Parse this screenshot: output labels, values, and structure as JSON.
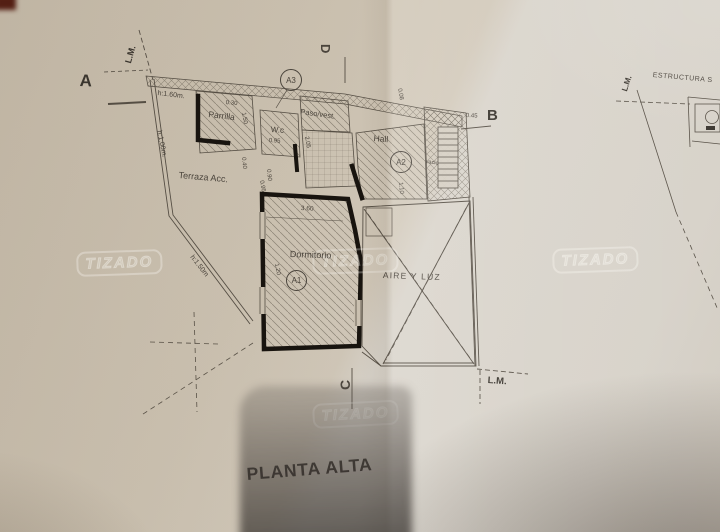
{
  "title": "PLANTA ALTA",
  "watermark_text": "TIZADO",
  "plan": {
    "rooms": {
      "parrilla": "Parrilla",
      "wc": "W.c",
      "paso_vest": "Paso/vest.",
      "hall": "Hall",
      "terraza": "Terraza Acc.",
      "dormitorio": "Dormitorio",
      "aire_y_luz": "AIRE Y LUZ",
      "vacio": "vacio"
    },
    "tags": {
      "a1": "A1",
      "a2": "A2",
      "a3": "A3"
    },
    "section_marks": {
      "a": "A",
      "b": "B",
      "c": "C",
      "d": "D"
    },
    "boundary": {
      "lm_top_left": "L.M.",
      "lm_bottom_right": "L.M.",
      "lm_top_right": "L.M."
    },
    "heights": {
      "parapet_160": "h:1.60m.",
      "parapet_100": "h:1.00m.",
      "parapet_150": "h:1.50m"
    },
    "dimensions": {
      "parrilla_width": "0.30",
      "parrilla_side": "1.50",
      "wc_width": "0.95",
      "paso_depth": "2.05",
      "wall_040": "0.40",
      "wall_090": "0.90",
      "wall_008": "0.08",
      "b_offset": "0.45",
      "hall_110": "1.10",
      "dorm_width": "3.60",
      "dorm_left": "0.95",
      "dorm_a1": "1.20"
    },
    "side_note": "ESTRUCTURA S"
  }
}
